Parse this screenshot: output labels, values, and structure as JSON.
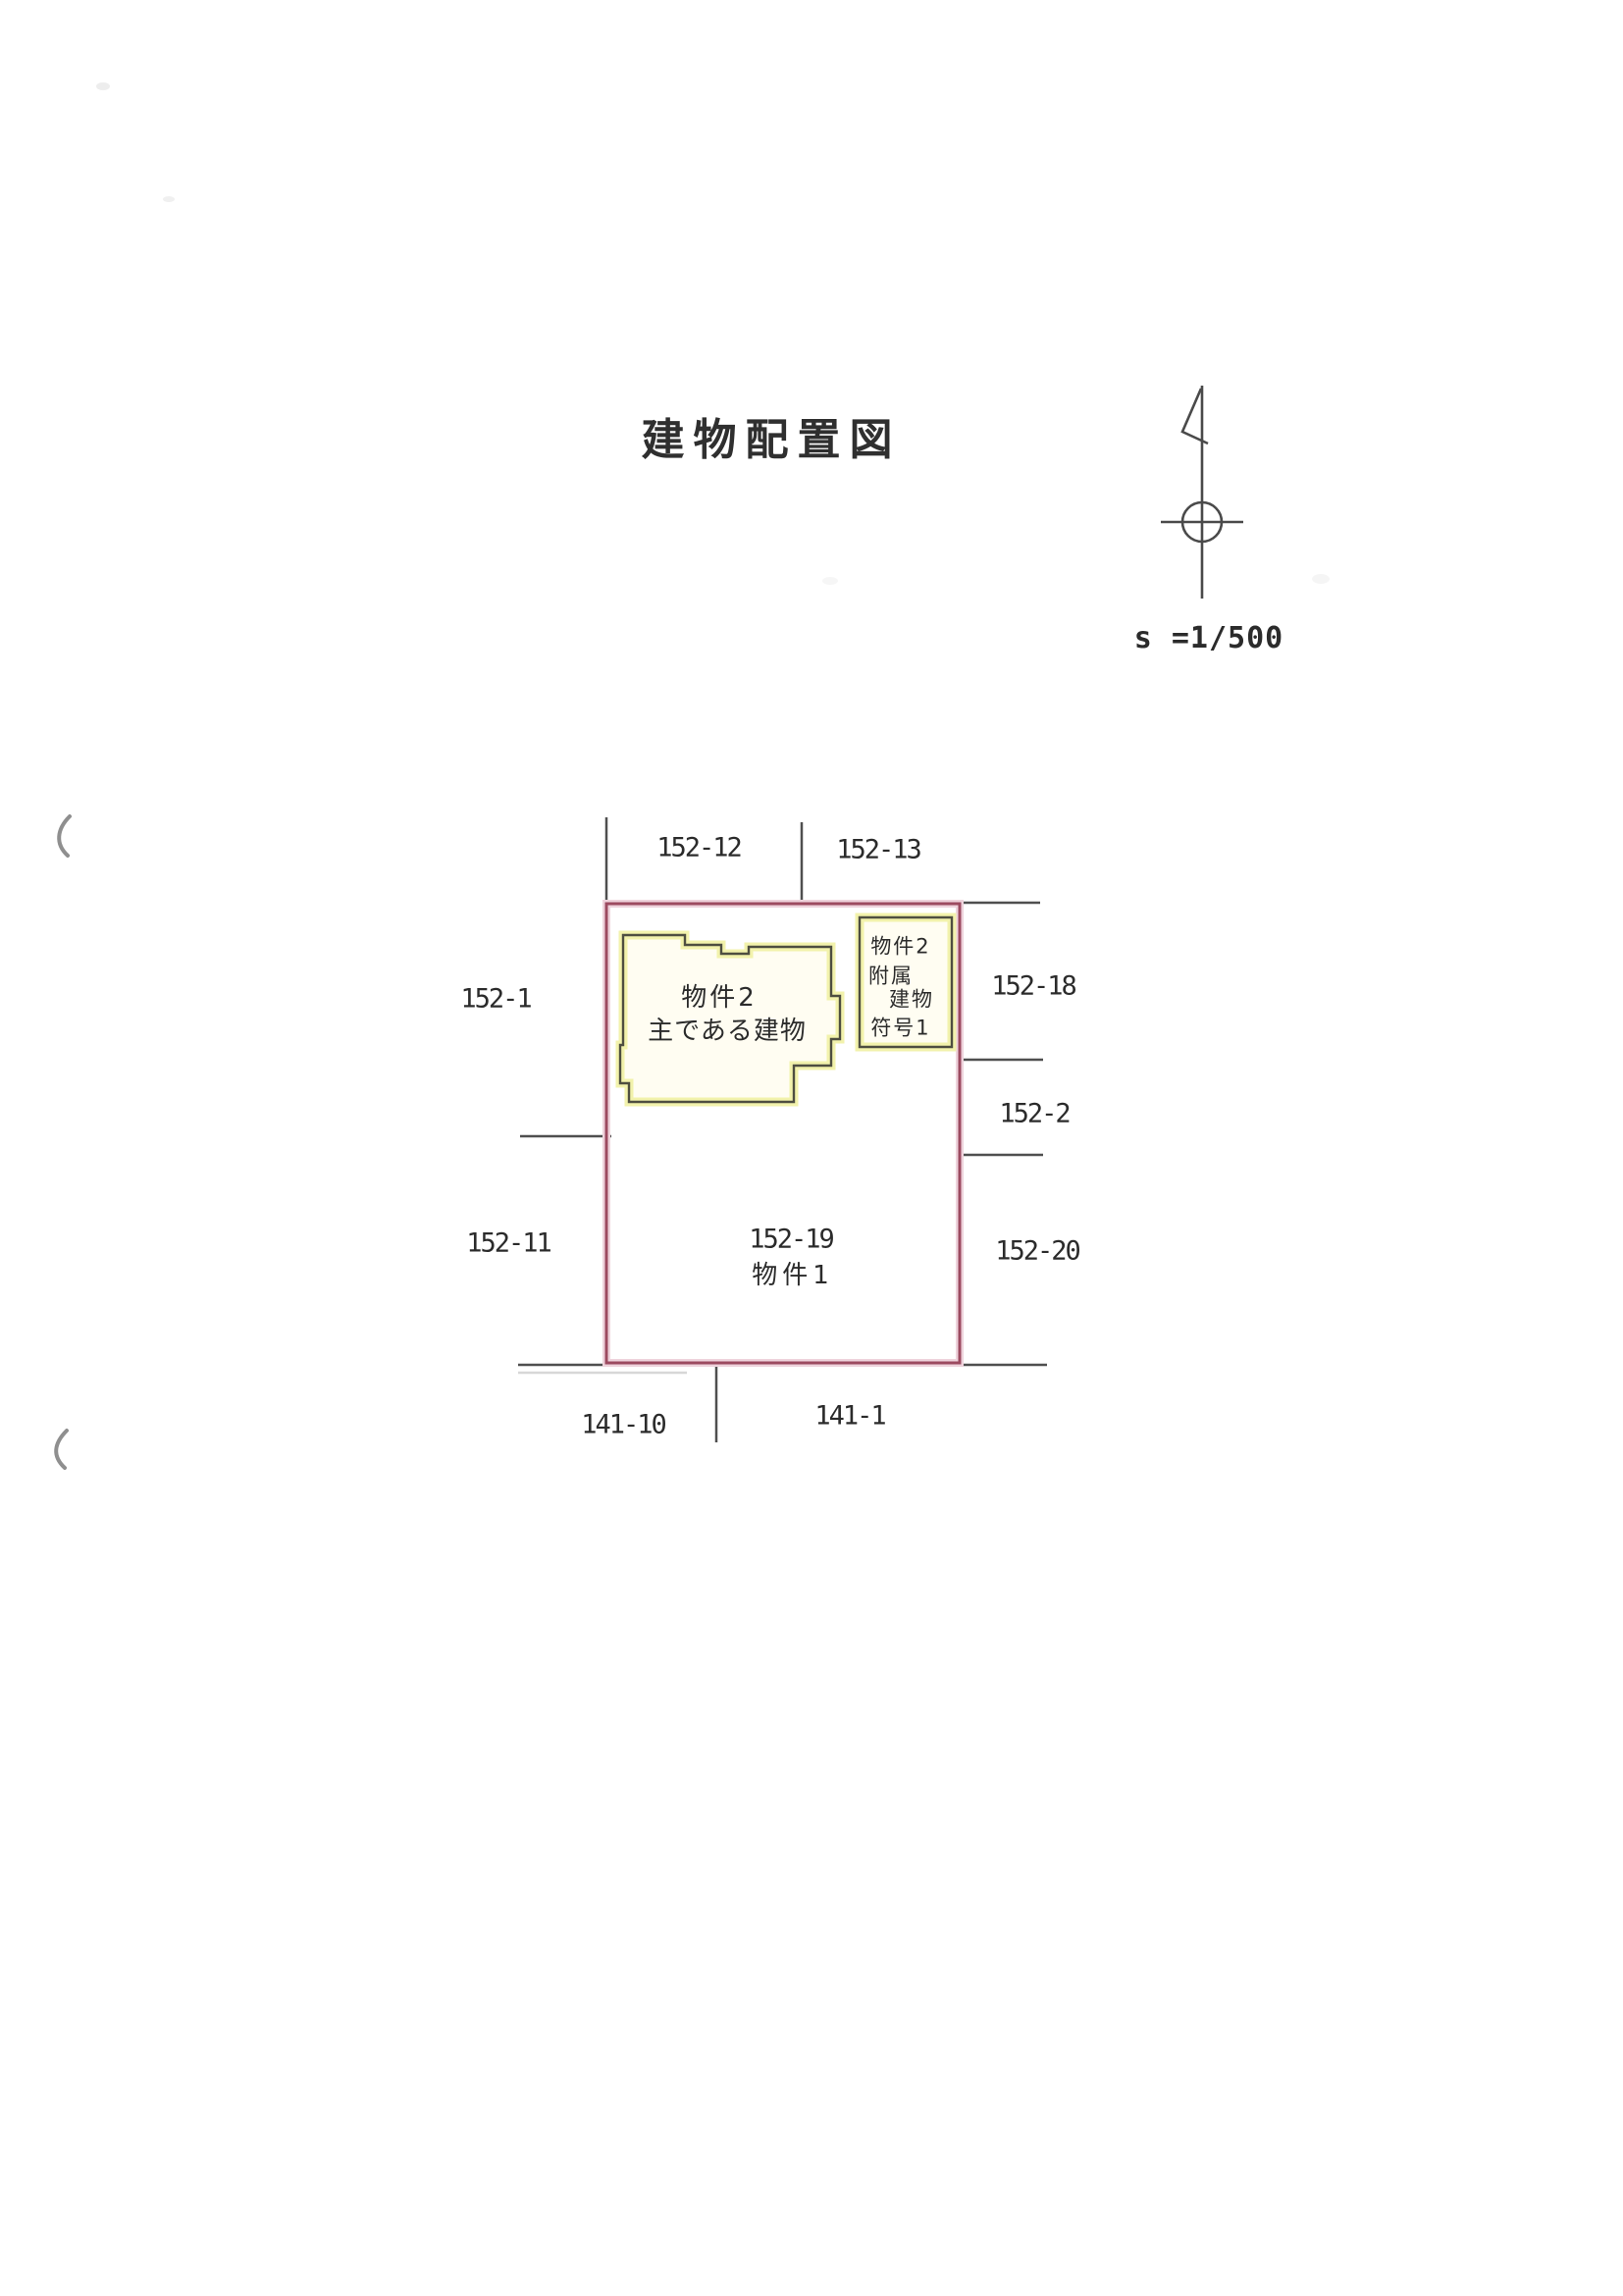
{
  "title": "建物配置図",
  "scale_label": "s =1/500",
  "plot": {
    "inner_parcel_number": "152-19",
    "inner_parcel_name": "物件1"
  },
  "main_building": {
    "line1": "物件2",
    "line2": "主である建物"
  },
  "attached_building": {
    "line1": "物件2",
    "line2": "附属",
    "line3": "建物",
    "line4": "符号1"
  },
  "parcels": {
    "top_left": "152-12",
    "top_right": "152-13",
    "left_upper": "152-1",
    "left_lower": "152-11",
    "right_upper": "152-18",
    "right_middle": "152-2",
    "right_lower": "152-20",
    "bottom_left": "141-10",
    "bottom_right": "141-1"
  },
  "colors": {
    "boundary": "#9c4a60",
    "boundary_glow": "#eed3dc",
    "division_line": "#4f4f4f",
    "building_outline": "#4e4e40",
    "building_band": "#f2f2ac",
    "building_fill": "#fffdf2",
    "ink": "#2b2b2b"
  }
}
